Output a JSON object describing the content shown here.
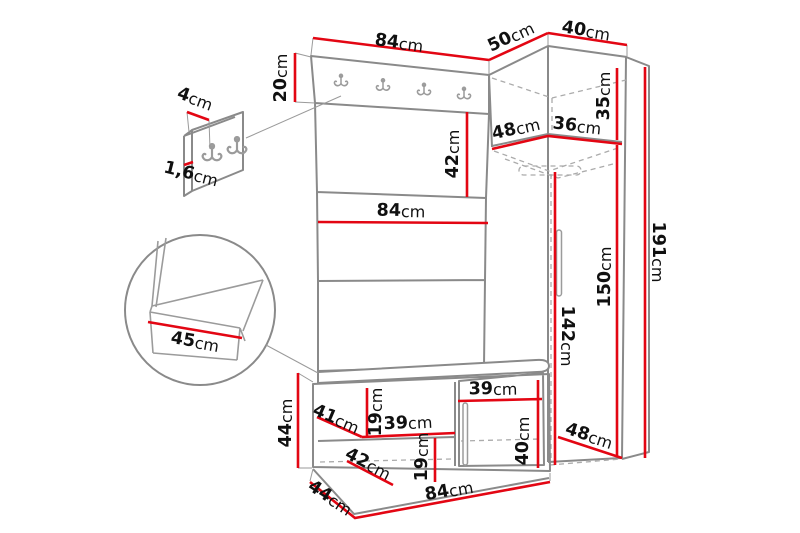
{
  "colors": {
    "dimension_line": "#e30613",
    "outline": "#8a8a8a",
    "label": "#101010",
    "background": "#ffffff"
  },
  "labels": {
    "hook_panel_detail_width": {
      "num": "4",
      "unit": "cm"
    },
    "hook_panel_detail_thickness": {
      "num": "1,6",
      "unit": "cm"
    },
    "hook_strip_height": {
      "num": "20",
      "unit": "cm"
    },
    "panel_width_top": {
      "num": "84",
      "unit": "cm"
    },
    "corner_top_width": {
      "num": "50",
      "unit": "cm"
    },
    "wardrobe_top_width": {
      "num": "40",
      "unit": "cm"
    },
    "top_cabinet_height": {
      "num": "35",
      "unit": "cm"
    },
    "top_cabinet_depth_left": {
      "num": "48",
      "unit": "cm"
    },
    "top_cabinet_depth_right": {
      "num": "36",
      "unit": "cm"
    },
    "panel_section_height": {
      "num": "42",
      "unit": "cm"
    },
    "panel_width_middle": {
      "num": "84",
      "unit": "cm"
    },
    "seat_depth_detail": {
      "num": "45",
      "unit": "cm"
    },
    "total_height": {
      "num": "191",
      "unit": "cm"
    },
    "wardrobe_interior_height": {
      "num": "150",
      "unit": "cm"
    },
    "wardrobe_door_height": {
      "num": "142",
      "unit": "cm"
    },
    "bench_height": {
      "num": "44",
      "unit": "cm"
    },
    "bench_shelf_depth": {
      "num": "41",
      "unit": "cm"
    },
    "bench_shelf_gap_height": {
      "num": "19",
      "unit": "cm"
    },
    "bench_shelf_width": {
      "num": "39",
      "unit": "cm"
    },
    "bench_door_width": {
      "num": "39",
      "unit": "cm"
    },
    "bench_lower_shelf_depth": {
      "num": "42",
      "unit": "cm"
    },
    "bench_lower_gap_height": {
      "num": "19",
      "unit": "cm"
    },
    "bench_door_height": {
      "num": "40",
      "unit": "cm"
    },
    "wardrobe_bottom_depth": {
      "num": "48",
      "unit": "cm"
    },
    "bench_bottom_depth": {
      "num": "44",
      "unit": "cm"
    },
    "bench_bottom_width": {
      "num": "84",
      "unit": "cm"
    }
  }
}
